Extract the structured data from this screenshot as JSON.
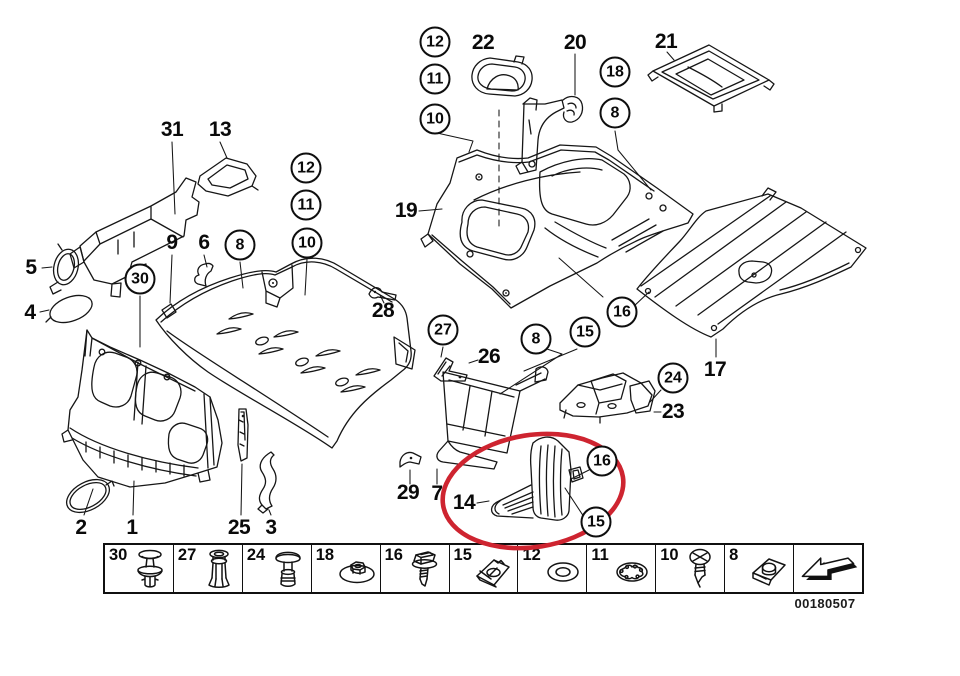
{
  "colors": {
    "line": "#161616",
    "background": "#ffffff",
    "highlight_red": "#ce2430"
  },
  "callouts": {
    "circled": [
      {
        "text": "12",
        "x": 435,
        "y": 42
      },
      {
        "text": "11",
        "x": 435,
        "y": 79
      },
      {
        "text": "10",
        "x": 435,
        "y": 119
      },
      {
        "text": "18",
        "x": 615,
        "y": 72
      },
      {
        "text": "8",
        "x": 615,
        "y": 113
      },
      {
        "text": "12",
        "x": 306,
        "y": 168
      },
      {
        "text": "11",
        "x": 306,
        "y": 205
      },
      {
        "text": "10",
        "x": 307,
        "y": 243
      },
      {
        "text": "8",
        "x": 240,
        "y": 245
      },
      {
        "text": "30",
        "x": 140,
        "y": 279
      },
      {
        "text": "27",
        "x": 443,
        "y": 330
      },
      {
        "text": "8",
        "x": 536,
        "y": 339
      },
      {
        "text": "15",
        "x": 585,
        "y": 332
      },
      {
        "text": "16",
        "x": 622,
        "y": 312
      },
      {
        "text": "24",
        "x": 673,
        "y": 378
      },
      {
        "text": "16",
        "x": 602,
        "y": 461
      },
      {
        "text": "15",
        "x": 596,
        "y": 522
      }
    ],
    "plain": [
      {
        "text": "22",
        "x": 483,
        "y": 43
      },
      {
        "text": "20",
        "x": 575,
        "y": 43
      },
      {
        "text": "21",
        "x": 666,
        "y": 42
      },
      {
        "text": "31",
        "x": 172,
        "y": 130
      },
      {
        "text": "13",
        "x": 220,
        "y": 130
      },
      {
        "text": "19",
        "x": 406,
        "y": 211
      },
      {
        "text": "5",
        "x": 31,
        "y": 268
      },
      {
        "text": "4",
        "x": 30,
        "y": 313
      },
      {
        "text": "9",
        "x": 172,
        "y": 243
      },
      {
        "text": "6",
        "x": 204,
        "y": 243
      },
      {
        "text": "28",
        "x": 383,
        "y": 311
      },
      {
        "text": "26",
        "x": 489,
        "y": 357
      },
      {
        "text": "17",
        "x": 715,
        "y": 370
      },
      {
        "text": "23",
        "x": 673,
        "y": 412
      },
      {
        "text": "29",
        "x": 408,
        "y": 493
      },
      {
        "text": "7",
        "x": 437,
        "y": 494
      },
      {
        "text": "14",
        "x": 464,
        "y": 503
      },
      {
        "text": "2",
        "x": 81,
        "y": 528
      },
      {
        "text": "1",
        "x": 132,
        "y": 528
      },
      {
        "text": "25",
        "x": 239,
        "y": 528
      },
      {
        "text": "3",
        "x": 271,
        "y": 528
      }
    ]
  },
  "highlight": {
    "type": "ellipse",
    "encircles_part": "14",
    "color": "#ce2430",
    "cx": 533,
    "cy": 491,
    "rx": 91,
    "ry": 56,
    "rotation_deg": -9
  },
  "legend": {
    "items": [
      {
        "label": "30",
        "icon": "push-rivet-icon"
      },
      {
        "label": "27",
        "icon": "expansion-rivet-icon"
      },
      {
        "label": "24",
        "icon": "rivet-pin-icon"
      },
      {
        "label": "18",
        "icon": "washer-nut-icon"
      },
      {
        "label": "16",
        "icon": "hex-screw-icon"
      },
      {
        "label": "15",
        "icon": "speed-nut-icon"
      },
      {
        "label": "12",
        "icon": "washer-icon"
      },
      {
        "label": "11",
        "icon": "lock-washer-icon"
      },
      {
        "label": "10",
        "icon": "phillips-screw-icon"
      },
      {
        "label": "8",
        "icon": "clip-nut-icon"
      },
      {
        "label": "",
        "icon": "back-arrow-icon"
      }
    ]
  },
  "footer": {
    "code": "00180507"
  }
}
